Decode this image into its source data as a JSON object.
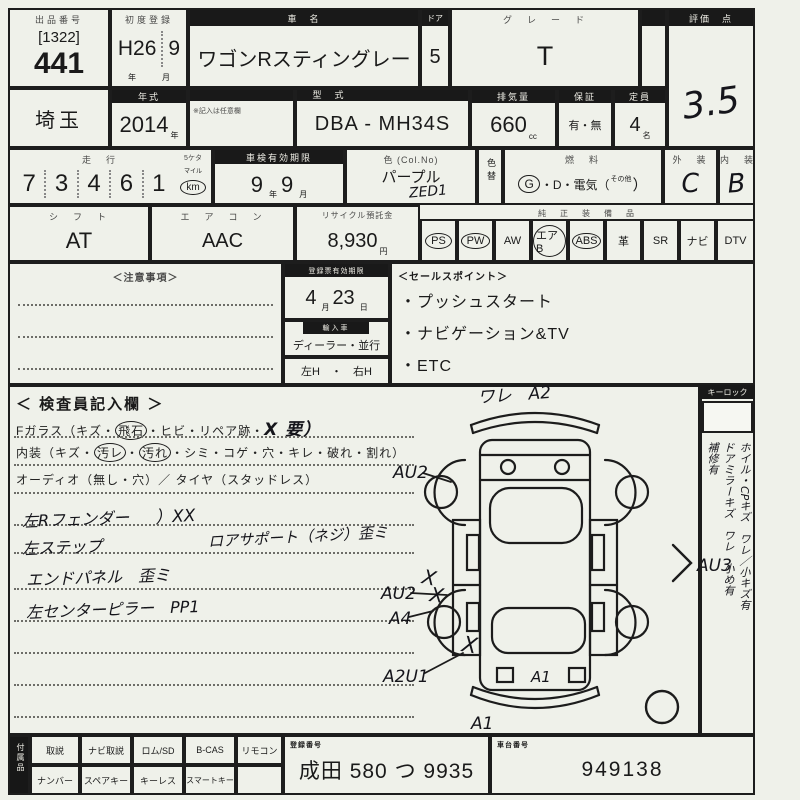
{
  "row1": {
    "lot_header": "出品番号",
    "lot_bracket": "[1322]",
    "lot_number": "441",
    "first_reg_header": "初度登録",
    "first_reg_era": "H26",
    "first_reg_month": "9",
    "first_reg_year_unit": "年",
    "first_reg_month_unit": "月",
    "car_name_header": "車　名",
    "car_name": "ワゴンRスティングレー",
    "doors_header": "ドア",
    "doors": "5",
    "grade_header": "グ　レ　ー　ド",
    "grade": "T",
    "score_header": "評価　点",
    "score": "3.5"
  },
  "row2": {
    "location": "埼玉",
    "year_header": "年式",
    "year": "2014",
    "year_unit": "年",
    "optional_note": "※記入は任意欄",
    "model_header": "型　式",
    "model": "DBA - MH34S",
    "disp_header": "排気量",
    "displacement": "660",
    "disp_unit": "cc",
    "warranty_header": "保証",
    "warranty": "有・無",
    "capacity_header": "定員",
    "capacity": "4",
    "capacity_unit": "名"
  },
  "row3": {
    "mileage_header": "走　行",
    "mileage_note": "5ケタ",
    "digits": [
      "7",
      "3",
      "4",
      "6",
      "1"
    ],
    "mileage_unit_small": "マイル",
    "mileage_unit": "km",
    "shaken_header": "車検有効期限",
    "shaken_year": "9",
    "shaken_year_unit": "年",
    "shaken_month": "9",
    "shaken_month_unit": "月",
    "color_header": "色 (Col.No)",
    "color": "パープル",
    "color_code": "ZED1",
    "color_change": "色替",
    "fuel_header": "燃　料",
    "fuel_g": "G",
    "fuel_mid": "・D・電気（",
    "fuel_other": "その他",
    "fuel_close": "）",
    "ext_header": "外　装",
    "ext": "C",
    "int_header": "内　装",
    "int": "B"
  },
  "row4": {
    "shift_header": "シ　フ　ト",
    "shift": "AT",
    "ac_header": "エ　ア　コ　ン",
    "ac": "AAC",
    "recycle_header": "リサイクル預託金",
    "recycle": "8,930",
    "recycle_unit": "円",
    "equip_header": "純　正　装　備　品",
    "equipment": [
      {
        "label": "PS",
        "circled": true
      },
      {
        "label": "PW",
        "circled": true
      },
      {
        "label": "AW",
        "circled": false
      },
      {
        "label": "エアB",
        "circled": true
      },
      {
        "label": "ABS",
        "circled": true
      },
      {
        "label": "革",
        "circled": false
      },
      {
        "label": "SR",
        "circled": false
      },
      {
        "label": "ナビ",
        "circled": false
      },
      {
        "label": "DTV",
        "circled": false
      }
    ]
  },
  "row5": {
    "notes_header": "＜注意事項＞",
    "reg_header": "登録票有効期限",
    "reg_month": "4",
    "reg_month_unit": "月",
    "reg_day": "23",
    "reg_day_unit": "日",
    "import_header": "輸入車",
    "import_value": "ディーラー・並行",
    "handle_value": "左H　・　右H",
    "sales_header": "＜セールスポイント＞",
    "sales_points": [
      "・プッシュスタート",
      "・ナビゲーション&TV",
      "・ETC"
    ]
  },
  "inspector": {
    "title": "＜ 検査員記入欄 ＞",
    "glass_prefix": "Fガラス（キズ・",
    "glass_circled": "飛石",
    "glass_mid": "・ヒビ・リペア跡・",
    "glass_hand": "X 要）",
    "interior_prefix": "内装（キズ・",
    "interior_c1": "汚レ",
    "interior_dot": "・",
    "interior_c2": "汚れ",
    "interior_rest": "・シミ・コゲ・穴・キレ・破れ・割れ）",
    "audio_line": "オーディオ（無し・穴）／ タイヤ（スタッドレス）",
    "note1": "左Rフェンダー",
    "note1b": "）XX",
    "note2": "左ステップ",
    "note2b": "ロアサポート（ネジ）歪ミ",
    "note3": "エンドパネル　歪ミ",
    "note4": "左センターピラー　PP1"
  },
  "diagram": {
    "label_top": "ワレ　A2",
    "label_left_upper": "AU2",
    "label_right": "AU3",
    "label_left_mid": "AU2",
    "label_left_mid2": "A4",
    "label_left_lower": "A2U1",
    "label_rear_panel": "A1",
    "label_rear_bottom": "A1",
    "mark": "X"
  },
  "sidebar": {
    "keylock_header": "キーロック",
    "col1": "ホイル・CPキズ　ワレ／小キズ有",
    "col2": "ドアミラーキズ　ワレ　小め有",
    "col3": "補修有"
  },
  "bottom": {
    "side_label": "付属品",
    "cells_top": [
      "取説",
      "ナビ取説",
      "ロム/SD",
      "B-CAS",
      "リモコン"
    ],
    "cells_bottom": [
      "ナンバー",
      "スペアキー",
      "キーレス",
      "スマートキー",
      ""
    ],
    "reg_header": "登録番号",
    "reg_no": "成田 580 つ 9935",
    "chassis_header": "車台番号",
    "chassis_no": "949138"
  }
}
